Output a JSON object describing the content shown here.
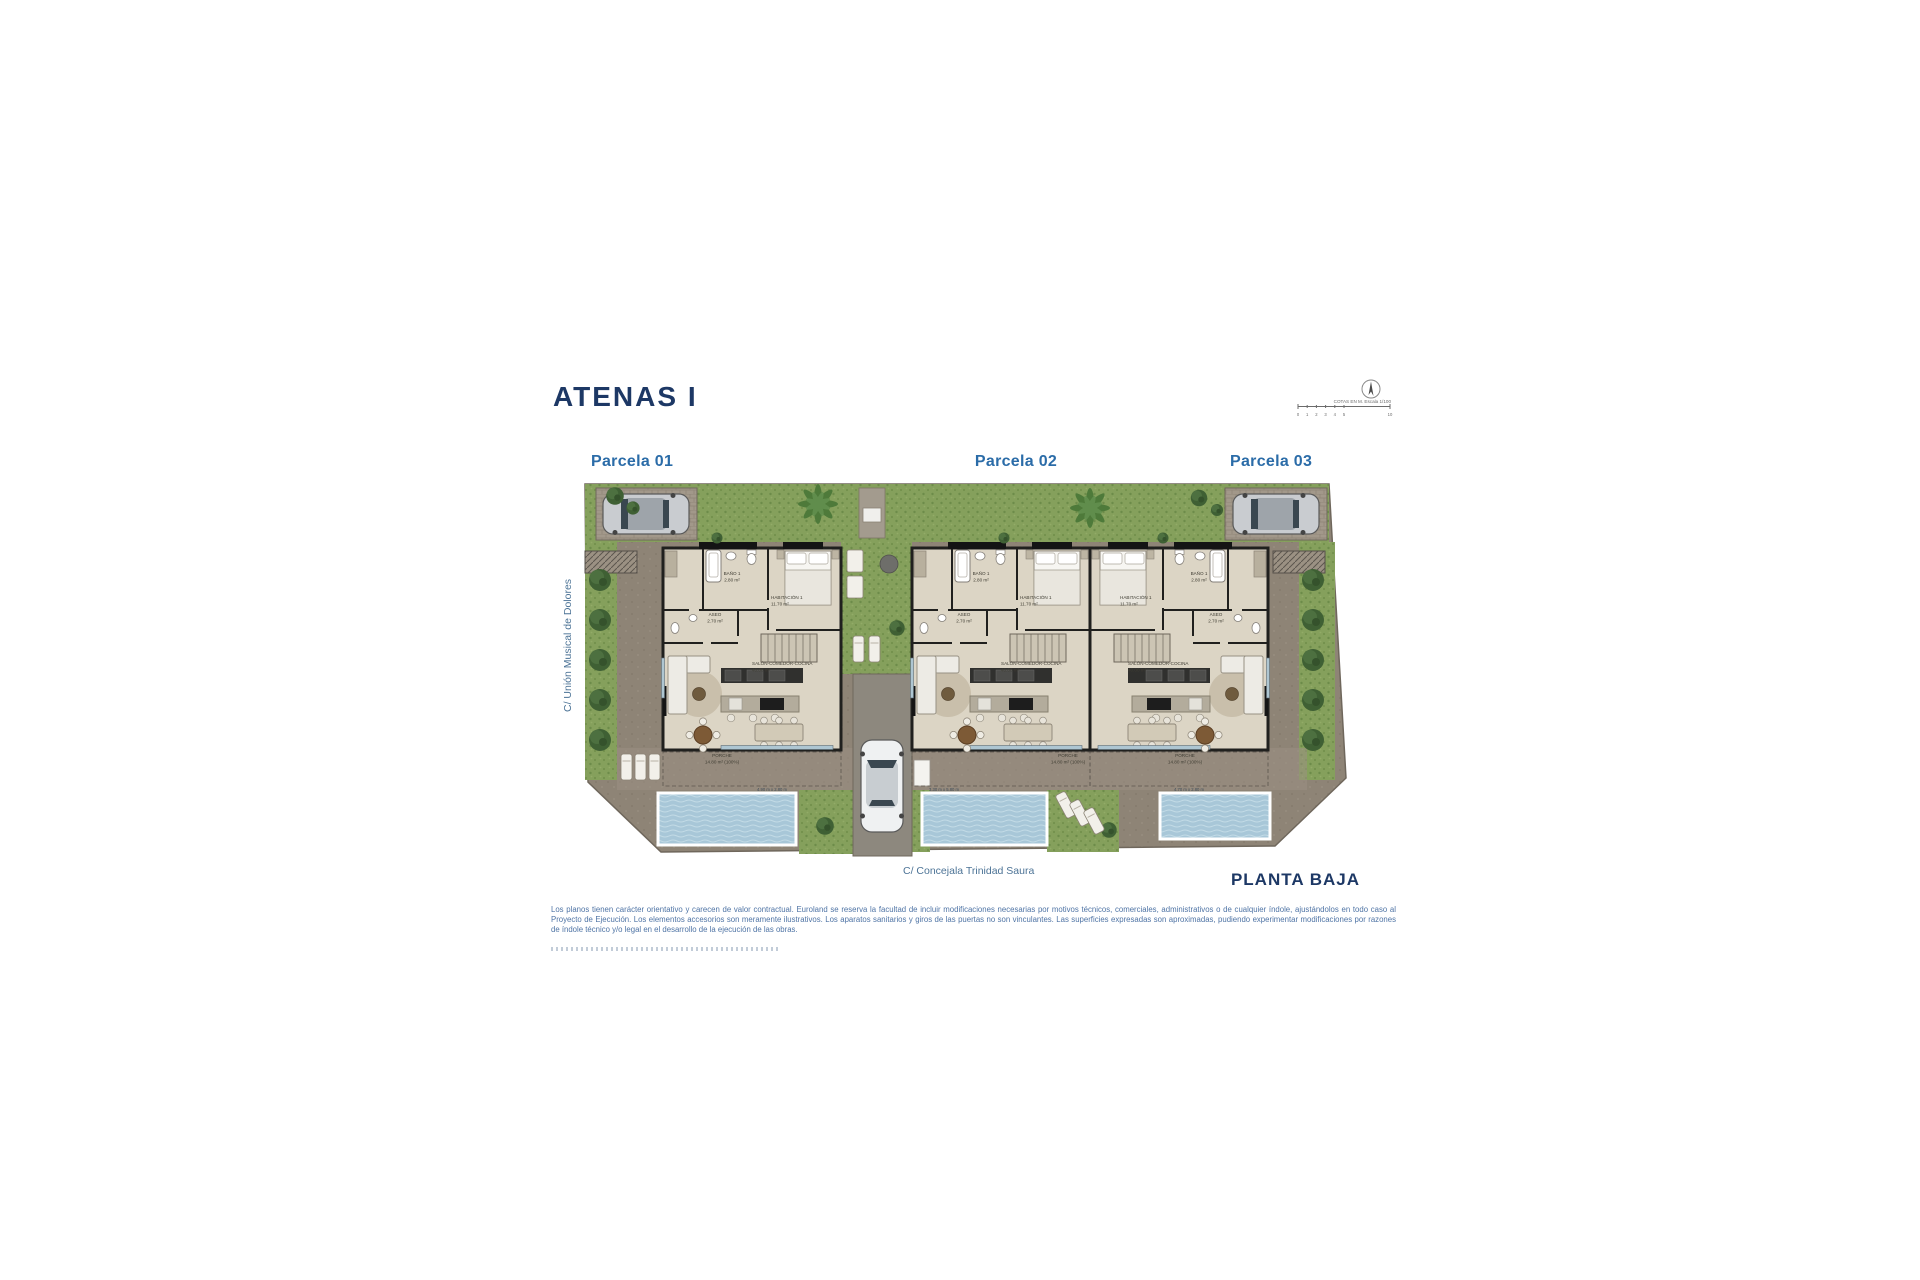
{
  "page": {
    "title": "ATENAS I",
    "plan_name": "PLANTA BAJA"
  },
  "parcels": [
    {
      "label": "Parcela 01"
    },
    {
      "label": "Parcela 02"
    },
    {
      "label": "Parcela 03"
    }
  ],
  "streets": {
    "left_vertical": "C/ Unión Musical de Dolores",
    "bottom": "C/ Concejala Trinidad Saura"
  },
  "scale": {
    "text": "COTAS EN M. Escala 1/100",
    "ticks": [
      "0",
      "1",
      "2",
      "3",
      "4",
      "5",
      "10"
    ]
  },
  "units": [
    {
      "rooms": {
        "bano_name": "BAÑO 1",
        "bano_area": "2.80 m²",
        "aseo_name": "ASEO",
        "aseo_area": "2.70 m²",
        "hab_name": "HABITACIÓN 1",
        "hab_area": "11.70 m²",
        "salon_name": "SALÓN-COMEDOR-COCINA",
        "salon_area": "40.00 m²",
        "porche_name": "PORCHE",
        "porche_area": "14.80 m² (100%)"
      },
      "pool_dim": "4.90 m x 2.80 m"
    },
    {
      "rooms": {
        "bano_name": "BAÑO 1",
        "bano_area": "2.80 m²",
        "aseo_name": "ASEO",
        "aseo_area": "2.70 m²",
        "hab_name": "HABITACIÓN 1",
        "hab_area": "11.70 m²",
        "salon_name": "SALÓN-COMEDOR-COCINA",
        "salon_area": "40.00 m²",
        "porche_name": "PORCHE",
        "porche_area": "14.80 m² (100%)"
      },
      "pool_dim": "3.30 m x 5.80 m"
    },
    {
      "rooms": {
        "bano_name": "BAÑO 1",
        "bano_area": "2.80 m²",
        "aseo_name": "ASEO",
        "aseo_area": "2.70 m²",
        "hab_name": "HABITACIÓN 1",
        "hab_area": "11.70 m²",
        "salon_name": "SALÓN-COMEDOR-COCINA",
        "salon_area": "40.00 m²",
        "porche_name": "PORCHE",
        "porche_area": "14.80 m² (100%)"
      },
      "pool_dim": "4.70 m x 2.80 m"
    }
  ],
  "disclaimer": "Los planos tienen carácter orientativo y carecen de valor contractual. Euroland se reserva la facultad de incluir modificaciones necesarias por motivos técnicos, comerciales, administrativos o de cualquier índole, ajustándolos en todo caso al Proyecto de Ejecución. Los elementos accesorios son meramente ilustrativos. Los aparatos sanitarios y giros de las puertas no son vinculantes. Las superficies expresadas son aproximadas, pudiendo experimentar modificaciones por razones de índole técnico y/o legal en el desarrollo de la ejecución de las obras.",
  "colors": {
    "title_navy": "#1d3865",
    "parcel_blue": "#2b6ca8",
    "street_blue": "#4c7396",
    "disclaimer_blue": "#4f74a5",
    "lawn_green": "#85a05c",
    "pool_blue": "#a8c7d8",
    "pavement": "#8e8476"
  }
}
